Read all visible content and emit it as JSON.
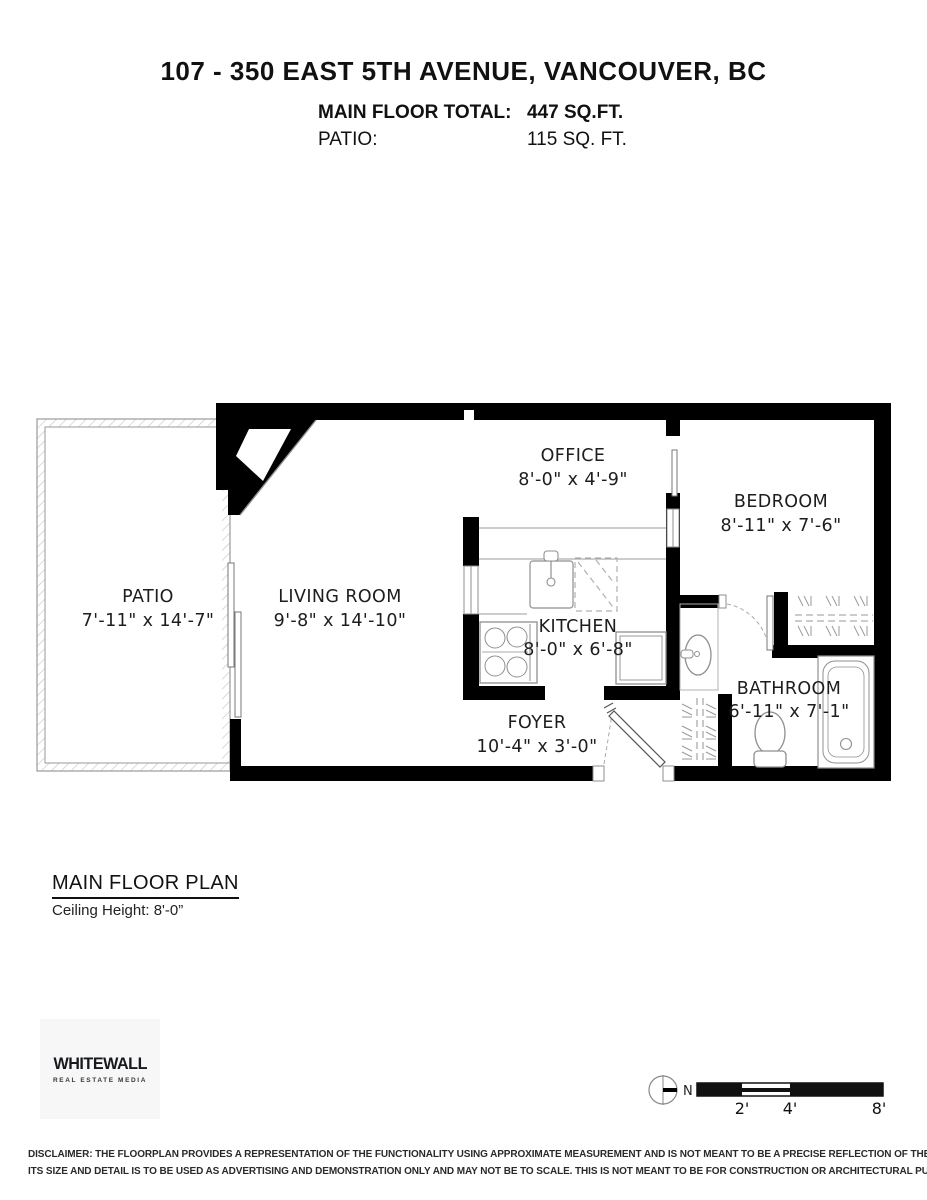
{
  "header": {
    "title": "107 - 350 EAST 5TH AVENUE, VANCOUVER, BC",
    "areas": [
      {
        "label": "MAIN FLOOR TOTAL:",
        "value": "447 SQ.FT."
      },
      {
        "label": "PATIO:",
        "value": "115 SQ. FT."
      }
    ]
  },
  "plan": {
    "rooms": [
      {
        "name": "PATIO",
        "dims": "7'-11\" x 14'-7\""
      },
      {
        "name": "LIVING ROOM",
        "dims": "9'-8\" x 14'-10\""
      },
      {
        "name": "OFFICE",
        "dims": "8'-0\" x 4'-9\""
      },
      {
        "name": "BEDROOM",
        "dims": "8'-11\" x 7'-6\""
      },
      {
        "name": "KITCHEN",
        "dims": "8'-0\" x 6'-8\""
      },
      {
        "name": "FOYER",
        "dims": "10'-4\" x 3'-0\""
      },
      {
        "name": "BATHROOM",
        "dims": "6'-11\" x 7'-1\""
      }
    ]
  },
  "caption": {
    "title": "MAIN FLOOR PLAN",
    "subtitle": "Ceiling Height: 8'-0”"
  },
  "logo": {
    "name": "WHITEWALL",
    "tagline": "REAL ESTATE MEDIA"
  },
  "compass": {
    "north_label": "N"
  },
  "scale_bar": {
    "tick_labels": [
      "2'",
      "4'",
      "8'"
    ]
  },
  "disclaimer": {
    "line1": "DISCLAIMER: THE FLOORPLAN PROVIDES A REPRESENTATION OF THE FUNCTIONALITY USING APPROXIMATE MEASUREMENT AND IS NOT MEANT TO BE A PRECISE REFLECTION OF THE PROPERTY,",
    "line2": "ITS SIZE AND DETAIL IS TO BE USED AS ADVERTISING AND DEMONSTRATION ONLY AND MAY NOT BE TO SCALE. THIS IS NOT MEANT TO BE FOR CONSTRUCTION OR ARCHITECTURAL PURPOSES. E&O INSURED"
  },
  "colors": {
    "wall": "#000000",
    "thin_line": "#8f8f8f",
    "text": "#1c1c1c"
  }
}
